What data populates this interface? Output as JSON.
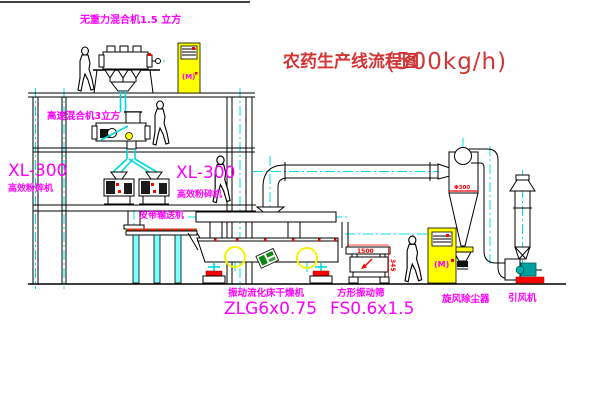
{
  "title": {
    "name": "农药生产线流程图",
    "capacity": "(500kg/h)"
  },
  "labels": {
    "gravity_mixer": "无重力混合机1.5 立方",
    "speed_mixer": "高速混合机3立方",
    "mill_left_model": "XL-300",
    "mill_left_name": "高效粉碎机",
    "mill_mid_model": "XL-300",
    "mill_mid_name": "高效粉碎机",
    "belt_conveyor": "皮带输送机",
    "dryer_name": "振动流化床干燥机",
    "dryer_model": "ZLG6x0.75",
    "sieve_name": "方形振动筛",
    "sieve_model": "FS0.6x1.5",
    "cyclone": "旋风除尘器",
    "fan": "引风机"
  },
  "dimensions": {
    "sieve_width": "1500",
    "sieve_height": "345",
    "cyclone_dia": "Φ300"
  },
  "cabinet": {
    "motor_symbol": "(M)"
  },
  "colors": {
    "label_magenta": "#ff00ff",
    "title_red": "#d23535",
    "dim_red": "#ff0000",
    "centerline_cyan": "#00e0e0",
    "cabinet_yellow": "#ffff00",
    "logo_green": "#0a8a0a",
    "fan_teal": "#00a0a0",
    "line_black": "#000000"
  }
}
